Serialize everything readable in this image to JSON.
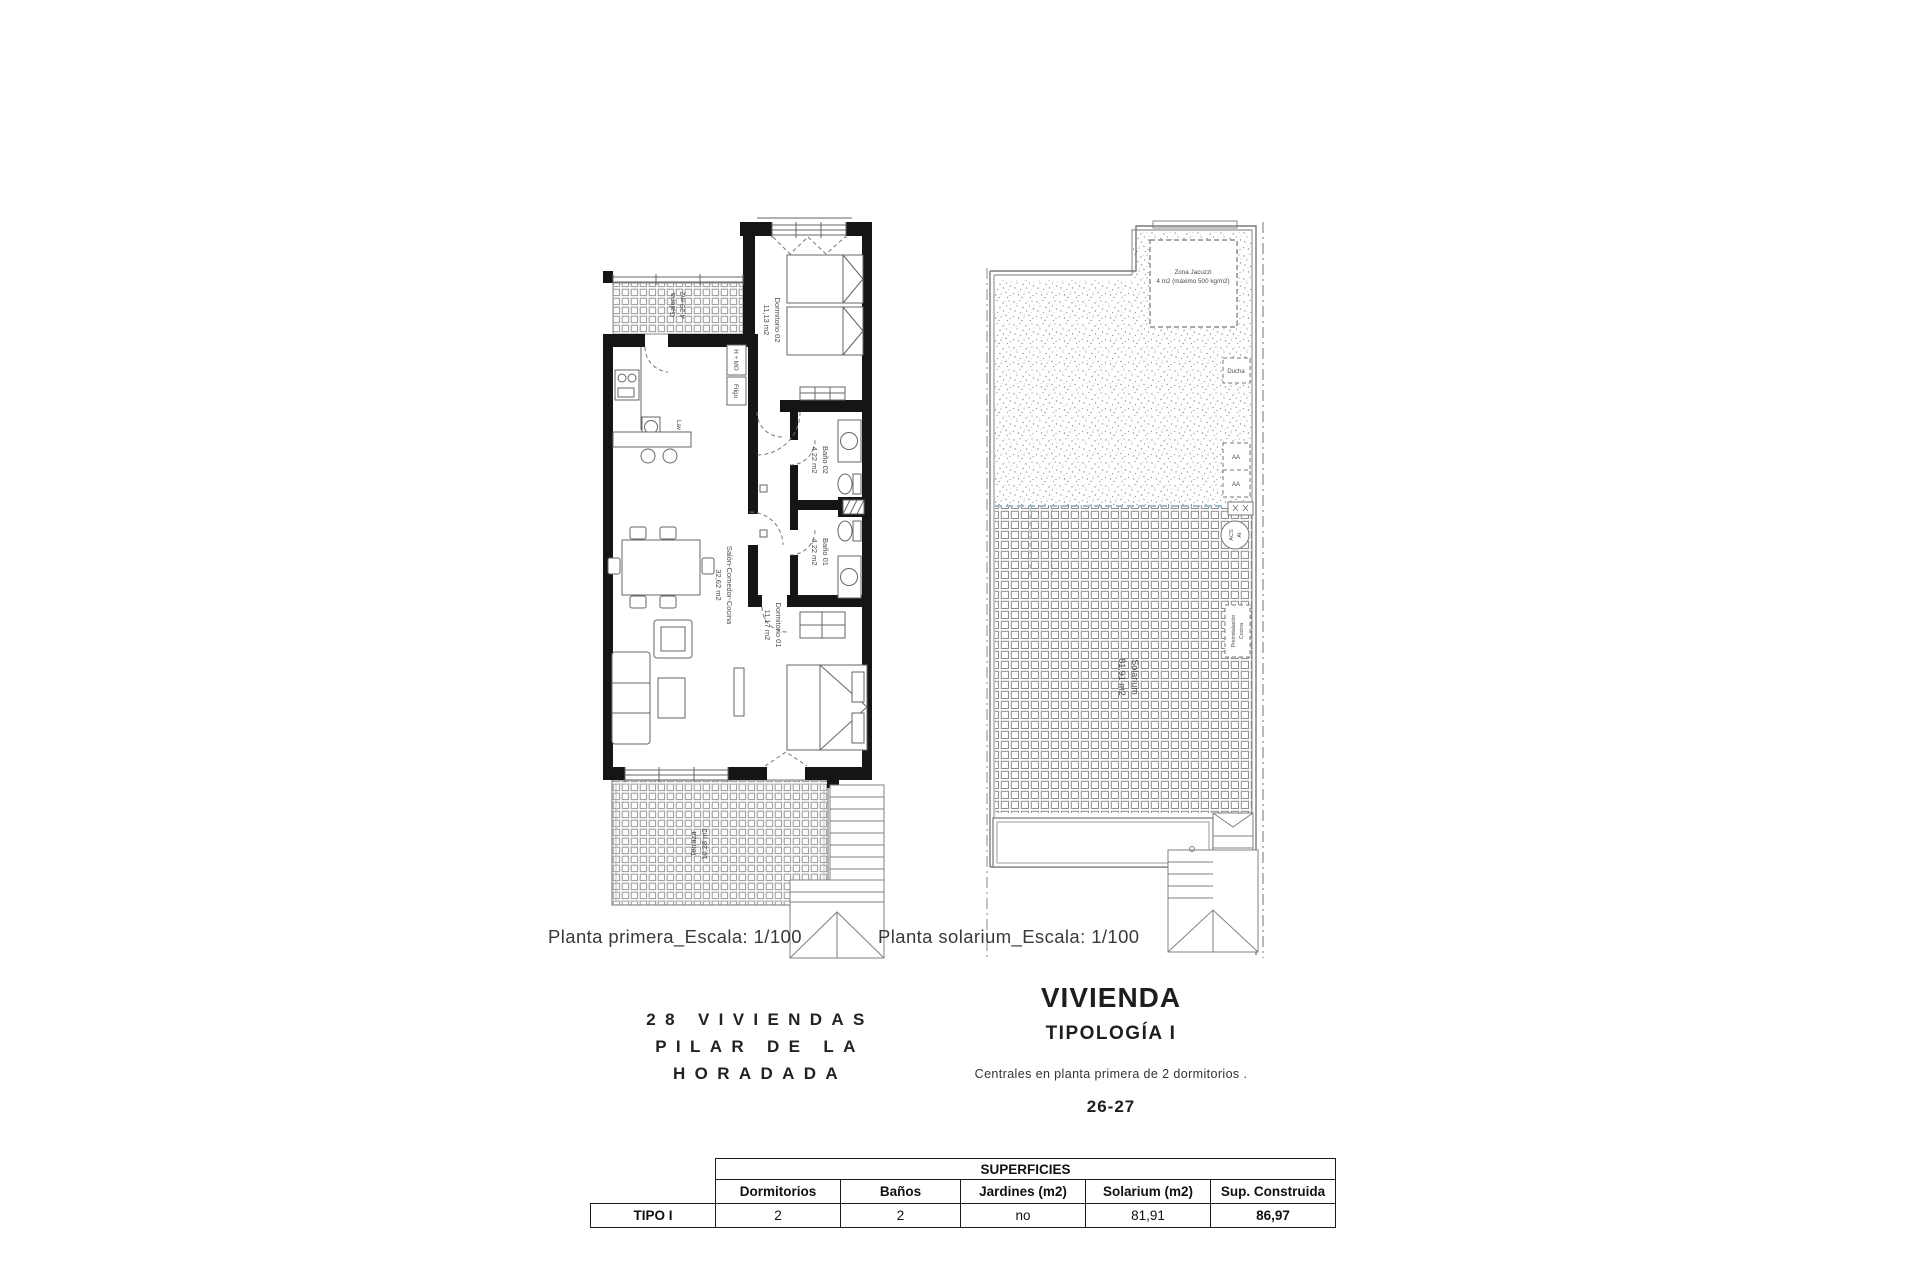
{
  "plans": {
    "primera": {
      "caption": "Planta primera_Escala: 1/100",
      "rooms": {
        "galeria": {
          "name": "Galeria",
          "area": "4,29 m2"
        },
        "dormitorio02": {
          "name": "Dormitorio 02",
          "area": "11,13 m2"
        },
        "bano02": {
          "name": "Baño 02",
          "area": "4,22 m2"
        },
        "bano01": {
          "name": "Baño 01",
          "area": "4,22 m2"
        },
        "salon": {
          "name": "Salón-Comedor-Cocina",
          "area": "32,62 m2"
        },
        "dormitorio01": {
          "name": "Dormitorio 01",
          "area": "11,17 m2"
        },
        "terraza": {
          "name": "Terraza",
          "area": "10,28 m2"
        }
      },
      "fixtures": {
        "horno": "H + MO",
        "frigo": "Frigo",
        "lavadora": "Lav"
      }
    },
    "solarium": {
      "caption": "Planta solarium_Escala: 1/100",
      "rooms": {
        "solarium": {
          "name": "Solarium",
          "area": "81,91 m2"
        },
        "jacuzzi": {
          "name": "Zona Jacuzzi",
          "note": "4 m2 (máximo 500 kg/m2)"
        },
        "ducha": {
          "name": "Ducha"
        },
        "aa1": {
          "name": "AA"
        },
        "aa2": {
          "name": "AA"
        },
        "acs": {
          "line1": "ACS",
          "line2": "At"
        },
        "preinstalacion": {
          "line1": "Preinstalación",
          "line2": "Cocina"
        }
      }
    }
  },
  "project": {
    "line1": "28 VIVIENDAS",
    "line2": "PILAR DE LA",
    "line3": "HORADADA"
  },
  "unit": {
    "title": "VIVIENDA",
    "subtitle": "TIPOLOGÍA I",
    "description": "Centrales en planta primera de 2 dormitorios .",
    "numbers": "26-27"
  },
  "table": {
    "title": "SUPERFICIES",
    "row_header": "TIPO I",
    "columns": [
      "Dormitorios",
      "Baños",
      "Jardines (m2)",
      "Solarium (m2)",
      "Sup. Construida"
    ],
    "values": [
      "2",
      "2",
      "no",
      "81,91",
      "86,97"
    ]
  }
}
